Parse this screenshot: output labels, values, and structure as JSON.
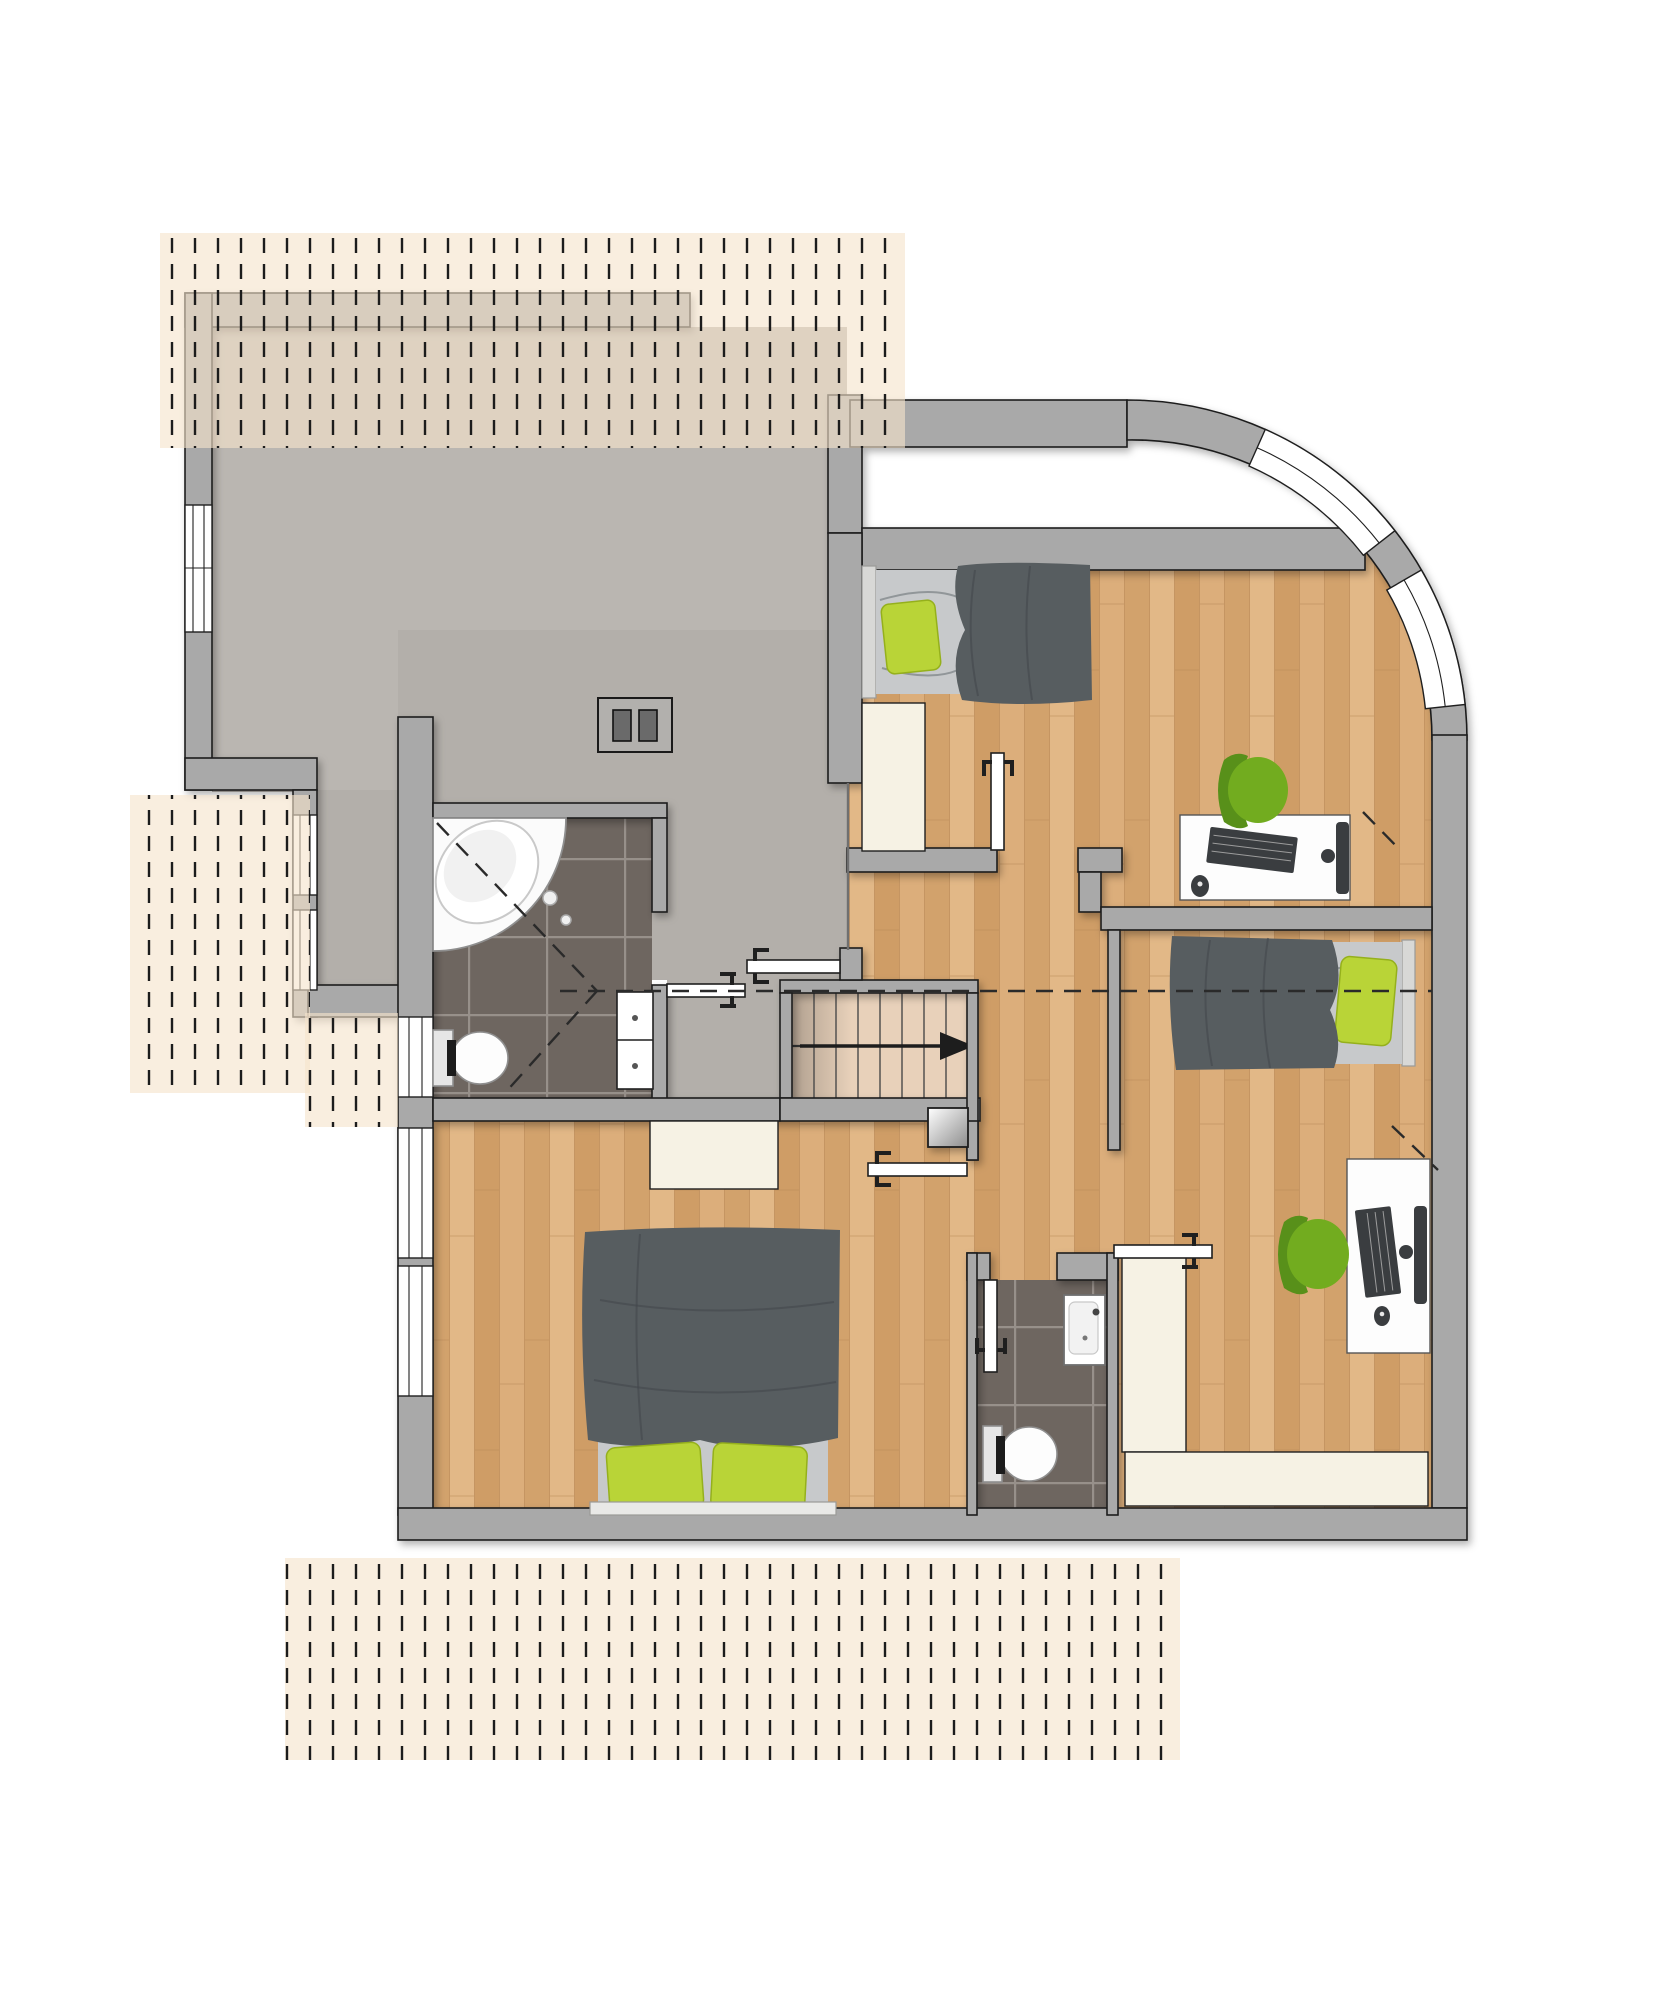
{
  "document": {
    "kind": "floor-plan",
    "floor": "upper-floor",
    "visible_text": [],
    "stair_arrow_direction": "east"
  },
  "rooms": [
    {
      "id": "terrace",
      "floor_finish": "concrete-gray",
      "features": [
        "parapet-walls",
        "chimney-with-two-flues",
        "roof-overhang-hatch"
      ]
    },
    {
      "id": "landing-hall",
      "floor_finish": "concrete-gray",
      "features": [
        "staircase",
        "roof-shaft"
      ]
    },
    {
      "id": "bathroom",
      "floor_finish": "dark-tiles",
      "fixtures": [
        "corner-bathtub",
        "toilet",
        "shelf-niche",
        "window"
      ],
      "roofline_dashes": true
    },
    {
      "id": "wc",
      "floor_finish": "dark-tiles",
      "fixtures": [
        "toilet",
        "washbasin"
      ]
    },
    {
      "id": "bedroom-north",
      "floor_finish": "wood",
      "furniture": [
        "single-bed",
        "wardrobe",
        "desk",
        "keyboard",
        "mouse",
        "monitor",
        "swivel-chair"
      ]
    },
    {
      "id": "bedroom-east",
      "floor_finish": "wood",
      "furniture": [
        "single-bed",
        "wardrobe",
        "desk",
        "keyboard",
        "mouse",
        "monitor",
        "swivel-chair",
        "sideboard"
      ]
    },
    {
      "id": "bedroom-southwest",
      "floor_finish": "wood",
      "furniture": [
        "double-bed",
        "two-pillows",
        "closet"
      ],
      "windows": 2
    },
    {
      "id": "corridor",
      "floor_finish": "wood"
    }
  ],
  "counts": {
    "beds": 3,
    "green_pillows": 4,
    "desks": 2,
    "chairs": 2,
    "doors": 6,
    "curved_windows": 2,
    "straight_windows": 6,
    "stair_treads": 8
  },
  "colors": {
    "wall": "#a9a9a9",
    "outline": "#1f1f1f",
    "concrete": "#bab6b1",
    "concrete2": "#b3afaa",
    "tile": "#6e6660",
    "grout": "#97908a",
    "wood1": "#dcae7b",
    "wood2": "#d2a26c",
    "wood3": "#e2b887",
    "wood4": "#cf9d66",
    "woodline": "#b98a58",
    "stair": "#e8d1ba",
    "hatchBg": "#f6e3cb",
    "hatchLine": "#1c1c1c",
    "cream": "#f6f2e4",
    "blanket": "#575d60",
    "mattress": "#c7c9cb",
    "pillow": "#b9d437",
    "chair": "#72ac1f",
    "dash": "#2a2a2a"
  }
}
